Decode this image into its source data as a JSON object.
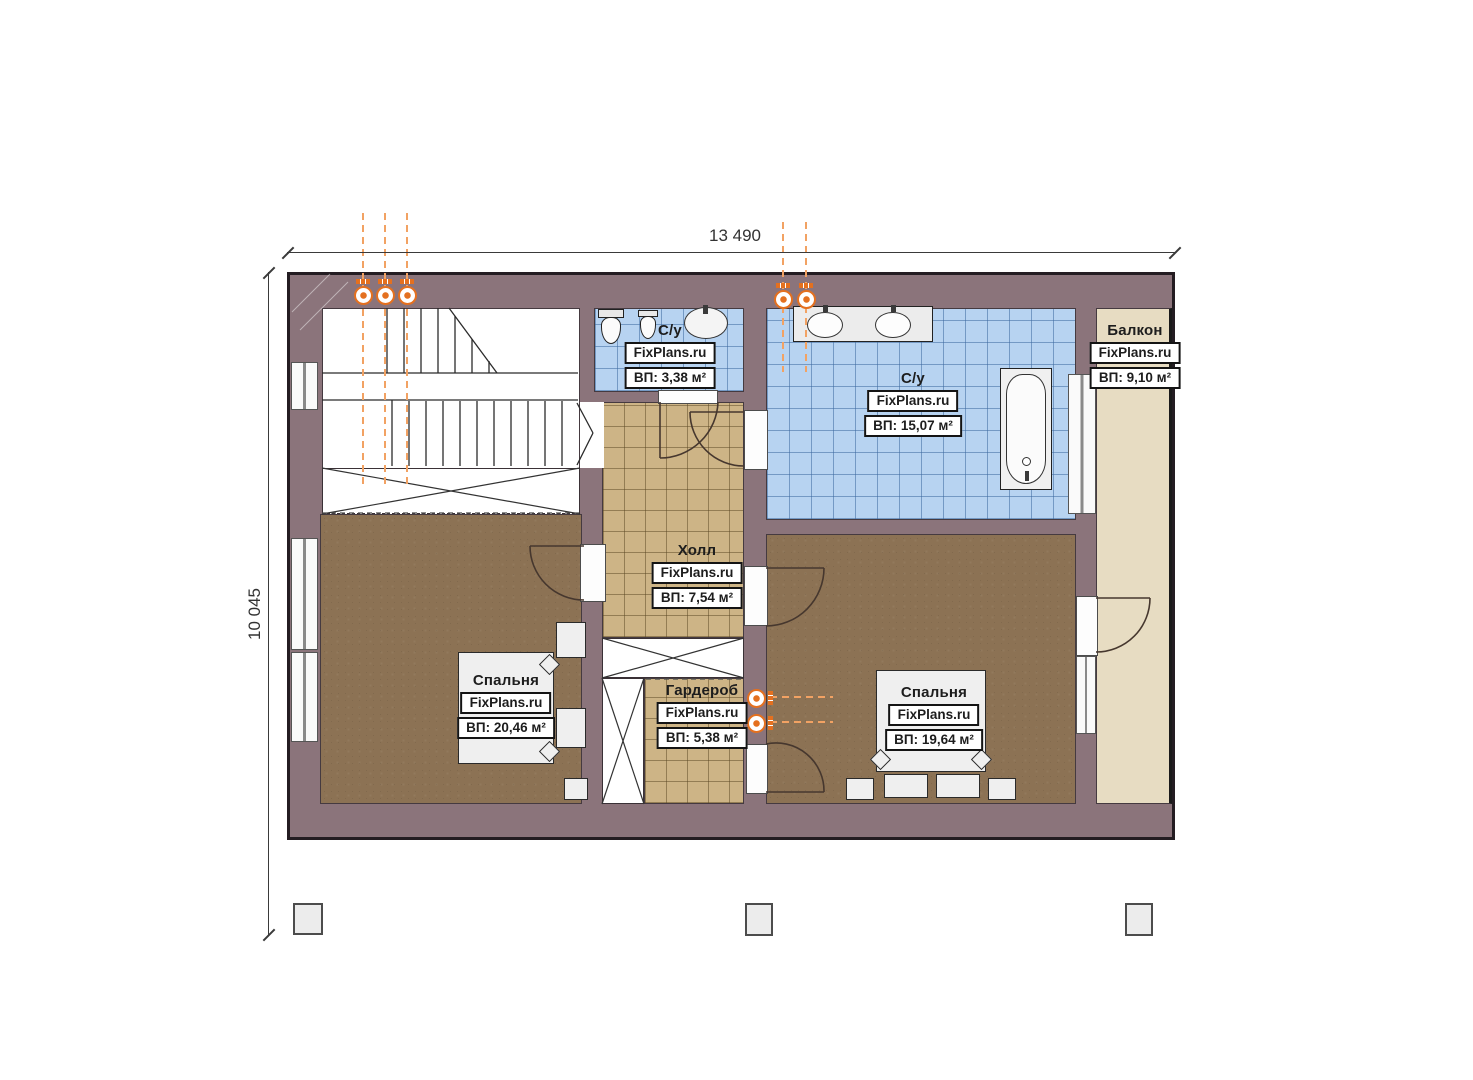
{
  "plan": {
    "title": "Floor plan (second floor)",
    "dimensions": {
      "width_label": "13 490",
      "height_label": "10 045"
    },
    "watermark": "FixPlans.ru",
    "rooms": {
      "small_bathroom": {
        "name": "С/у",
        "watermark": "FixPlans.ru",
        "area": "ВП: 3,38 м²"
      },
      "big_bathroom": {
        "name": "С/у",
        "watermark": "FixPlans.ru",
        "area": "ВП: 15,07 м²"
      },
      "hall": {
        "name": "Холл",
        "watermark": "FixPlans.ru",
        "area": "ВП: 7,54 м²"
      },
      "bedroom_left": {
        "name": "Спальня",
        "watermark": "FixPlans.ru",
        "area": "ВП: 20,46 м²"
      },
      "wardrobe": {
        "name": "Гардероб",
        "watermark": "FixPlans.ru",
        "area": "ВП: 5,38 м²"
      },
      "bedroom_right": {
        "name": "Спальня",
        "watermark": "FixPlans.ru",
        "area": "ВП: 19,64 м²"
      },
      "balcony": {
        "name": "Балкон",
        "watermark": "FixPlans.ru",
        "area": "ВП: 9,10 м²"
      }
    },
    "colors": {
      "wall": "#8b747b",
      "tile_tan": "#cdb486",
      "tile_blue": "#b7d3f1",
      "carpet": "#8c7254",
      "balcony_floor": "#e7dcc2",
      "radiator_orange": "#e4701f"
    }
  }
}
